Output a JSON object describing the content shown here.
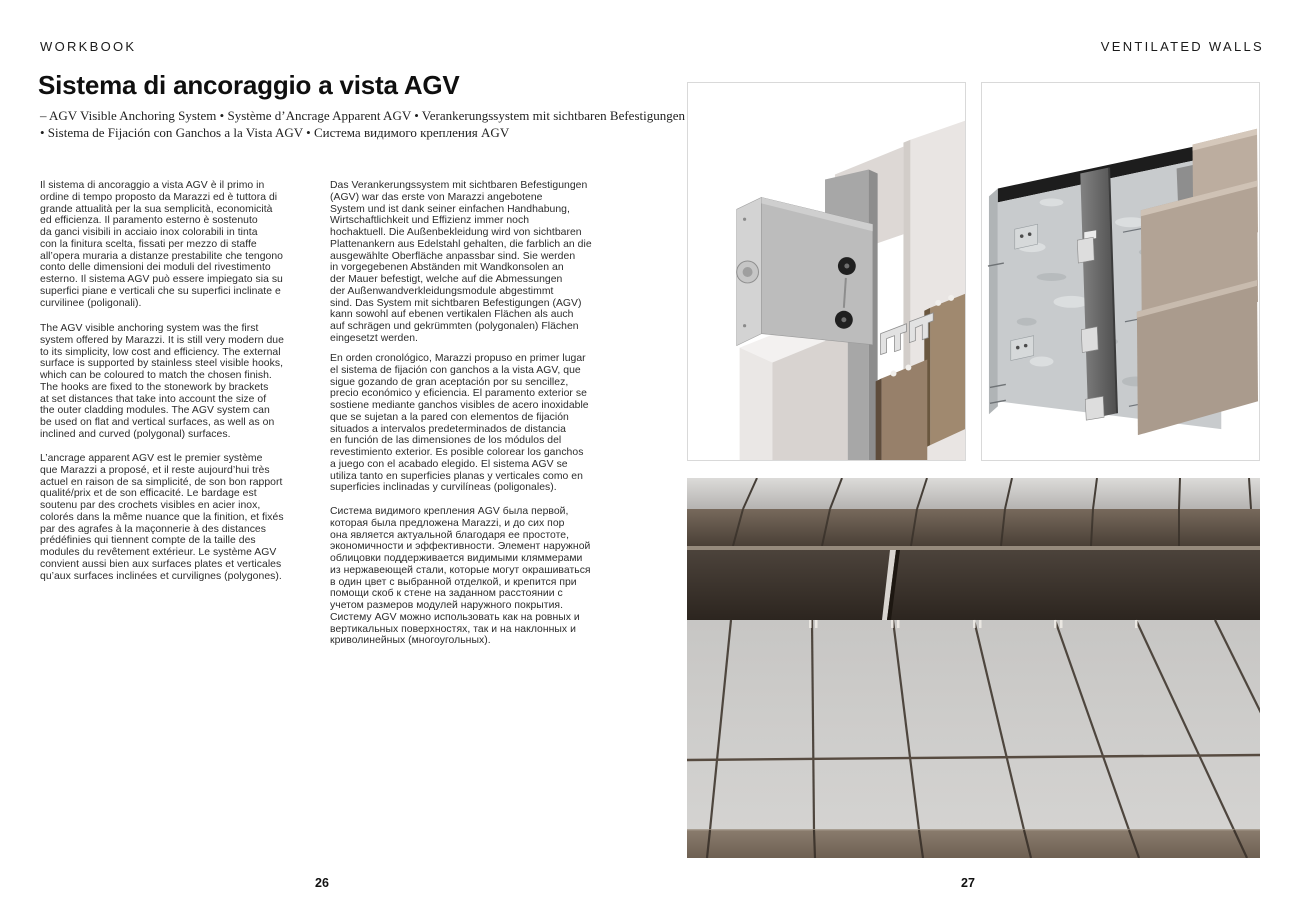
{
  "header": {
    "left": "WORKBOOK",
    "right": "VENTILATED WALLS"
  },
  "title": "Sistema di ancoraggio a vista AGV",
  "subtitle": {
    "line1": "– AGV Visible Anchoring System  •  Système d’Ancrage Apparent AGV  •  Verankerungssystem mit sichtbaren Befestigungen AGV",
    "line2": "•  Sistema de Fijación con Ganchos a la Vista AGV  •  Система видимого крепления AGV"
  },
  "body": {
    "italian": "Il sistema di ancoraggio a vista AGV è il primo in\nordine di tempo proposto da Marazzi ed è tuttora di\ngrande attualità per la sua semplicità, economicità\ned efficienza. Il paramento esterno è sostenuto\nda ganci visibili in acciaio inox colorabili in tinta\ncon la finitura scelta, fissati per mezzo di staffe\nall’opera muraria a distanze prestabilite che tengono\nconto delle dimensioni dei moduli del rivestimento\nesterno. Il sistema AGV può essere impiegato sia su\nsuperfici piane e verticali che su superfici inclinate e\ncurvilinee (poligonali).",
    "english": "The AGV visible anchoring system was the first\nsystem offered by Marazzi. It is still very modern due\nto its simplicity, low cost and efficiency. The external\nsurface is supported by stainless steel visible hooks,\nwhich can be coloured to match the chosen finish.\nThe hooks are fixed to the stonework by brackets\nat set distances that take into account the size of\nthe outer cladding modules. The AGV system can\nbe used on flat and vertical surfaces, as well as on\ninclined and curved (polygonal) surfaces.",
    "french": "L’ancrage apparent AGV est le premier système\nque Marazzi a proposé, et il reste aujourd’hui très\nactuel en raison de sa simplicité, de son bon rapport\nqualité/prix et de son efficacité. Le bardage est\nsoutenu par des crochets visibles en acier inox,\ncolorés dans la même nuance que la finition, et fixés\npar des agrafes à la maçonnerie à des distances\nprédéfinies qui tiennent compte de la taille des\nmodules du revêtement extérieur. Le système AGV\nconvient aussi bien aux surfaces plates et verticales\nqu’aux surfaces inclinées et curvilignes (polygones).",
    "german": "Das Verankerungssystem mit sichtbaren Befestigungen\n(AGV) war das erste von Marazzi angebotene\nSystem und ist dank seiner einfachen Handhabung,\nWirtschaftlichkeit und Effizienz immer noch\nhochaktuell. Die Außenbekleidung wird von sichtbaren\nPlattenankern aus Edelstahl gehalten, die farblich an die\nausgewählte Oberfläche anpassbar sind. Sie werden\nin vorgegebenen Abständen mit Wandkonsolen an\nder Mauer befestigt, welche auf die Abmessungen\nder Außenwandverkleidungsmodule abgestimmt\nsind. Das System mit sichtbaren Befestigungen (AGV)\nkann sowohl auf ebenen vertikalen Flächen als auch\nauf schrägen und gekrümmten (polygonalen) Flächen\neingesetzt werden.",
    "spanish": "En orden cronológico, Marazzi propuso en primer lugar\nel sistema de fijación con ganchos a la vista AGV, que\nsigue gozando de gran aceptación por su sencillez,\nprecio económico y eficiencia. El paramento exterior se\nsostiene mediante ganchos visibles de acero inoxidable\nque se sujetan a la pared con elementos de fijación\nsituados a intervalos predeterminados de distancia\nen función de las dimensiones de los módulos del\nrevestimiento exterior. Es posible colorear los ganchos\na juego con el acabado elegido. El sistema AGV se\nutiliza tanto en superficies planas y verticales como en\nsuperficies inclinadas y curvilíneas (poligonales).",
    "russian": "Система видимого крепления AGV была первой,\nкоторая была предложена Marazzi, и до сих пор\nона является актуальной благодаря ее простоте,\nэкономичности и эффективности. Элемент наружной\nоблицовки поддерживается видимыми кляммерами\nиз нержавеющей стали, которые могут окрашиваться\nв один цвет с выбранной отделкой, и крепится при\nпомощи скоб к стене на заданном расстоянии с\nучетом размеров модулей наружного покрытия.\nСистему AGV можно использовать как на ровных и\nвертикальных поверхностях, так и на наклонных и\nкриволинейных (многоугольных)."
  },
  "footer": {
    "page_left": "26",
    "page_right": "27"
  },
  "figures": {
    "bracket_detail": "AGV visible anchoring bracket detail render",
    "exploded_view": "Ventilated wall exploded assembly render",
    "facade_photo": "Tiled facade with visible hooks photo"
  },
  "colors": {
    "text": "#2c2c2c",
    "figure_border": "#d9d9d9",
    "metal_gray": "#a9a9a9",
    "concrete_gray": "#c8cbcd",
    "cladding_brown": "#97806a",
    "tile_light_gray": "#cdccca",
    "recess_dark": "#352d26"
  }
}
